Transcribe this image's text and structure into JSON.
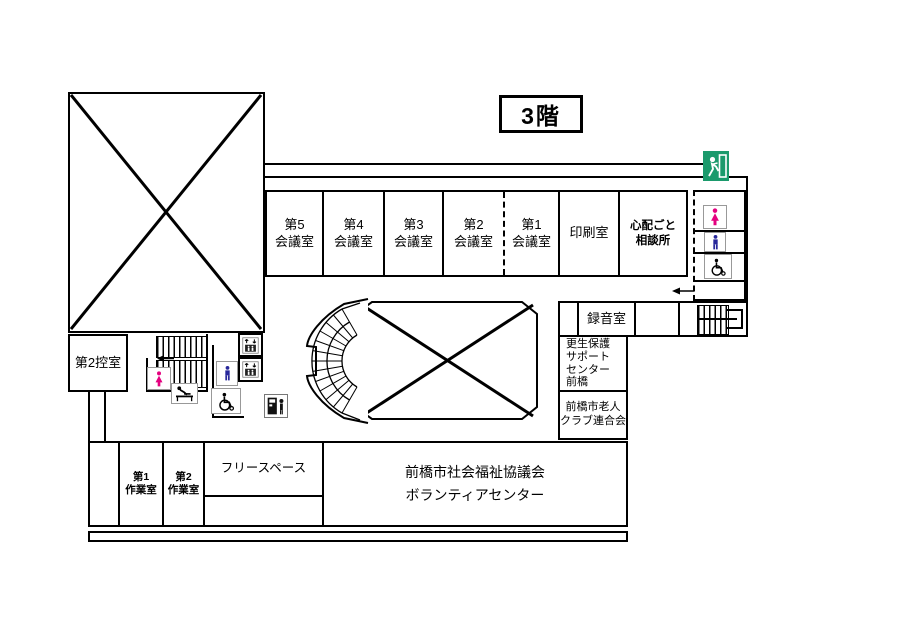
{
  "title": "3階",
  "rooms": {
    "meeting5": "第5\n会議室",
    "meeting4": "第4\n会議室",
    "meeting3": "第3\n会議室",
    "meeting2": "第2\n会議室",
    "meeting1": "第1\n会議室",
    "print": "印刷室",
    "worry_consultation": "心配ごと\n相談所",
    "recording": "録音室",
    "rehabilitation_support": "更生保護\nサポート\nセンター\n前橋",
    "elderly_club": "前橋市老人\nクラブ連合会",
    "waiting2": "第2控室",
    "workshop1": "第1\n作業室",
    "workshop2": "第2\n作業室",
    "free_space": "フリースペース",
    "volunteer_center": "前橋市社会福祉協議会\nボランティアセンター"
  },
  "icons": {
    "exit": "emergency-exit",
    "toilet_female": "female-toilet",
    "toilet_male": "male-toilet",
    "wheelchair": "wheelchair-accessible",
    "elevator": "elevator",
    "baby_changing": "baby-changing-station",
    "vending": "vending-machine",
    "stairs_main": "stairs",
    "stairs_right": "stairs",
    "stairs_curved": "curved-stairs"
  },
  "colors": {
    "female_pink": "#e4007f",
    "male_blue": "#28289b",
    "exit_green": "#1b9a6c",
    "line": "#000000"
  }
}
